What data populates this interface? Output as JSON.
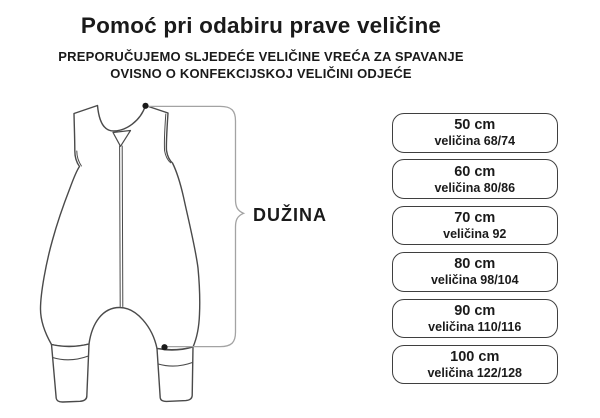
{
  "header": {
    "title": "Pomoć pri odabiru prave veličine",
    "subtitle_line1": "PREPORUČUJEMO SLJEDEĆE VELIČINE VREĆA ZA SPAVANJE",
    "subtitle_line2": "OVISNO O KONFEKCIJSKOJ VELIČINI ODJEĆE"
  },
  "diagram": {
    "label": "DUŽINA"
  },
  "sizes": [
    {
      "length": "50 cm",
      "size": "veličina 68/74"
    },
    {
      "length": "60 cm",
      "size": "veličina 80/86"
    },
    {
      "length": "70 cm",
      "size": "veličina 92"
    },
    {
      "length": "80 cm",
      "size": "veličina 98/104"
    },
    {
      "length": "90 cm",
      "size": "veličina 110/116"
    },
    {
      "length": "100 cm",
      "size": "veličina 122/128"
    }
  ],
  "colors": {
    "background": "#ffffff",
    "text": "#1a1a1a",
    "garment_outline": "#4a4a4a",
    "bracket": "#a3a3a3",
    "box_border": "#3f3f3f",
    "dot": "#1a1a1a"
  }
}
